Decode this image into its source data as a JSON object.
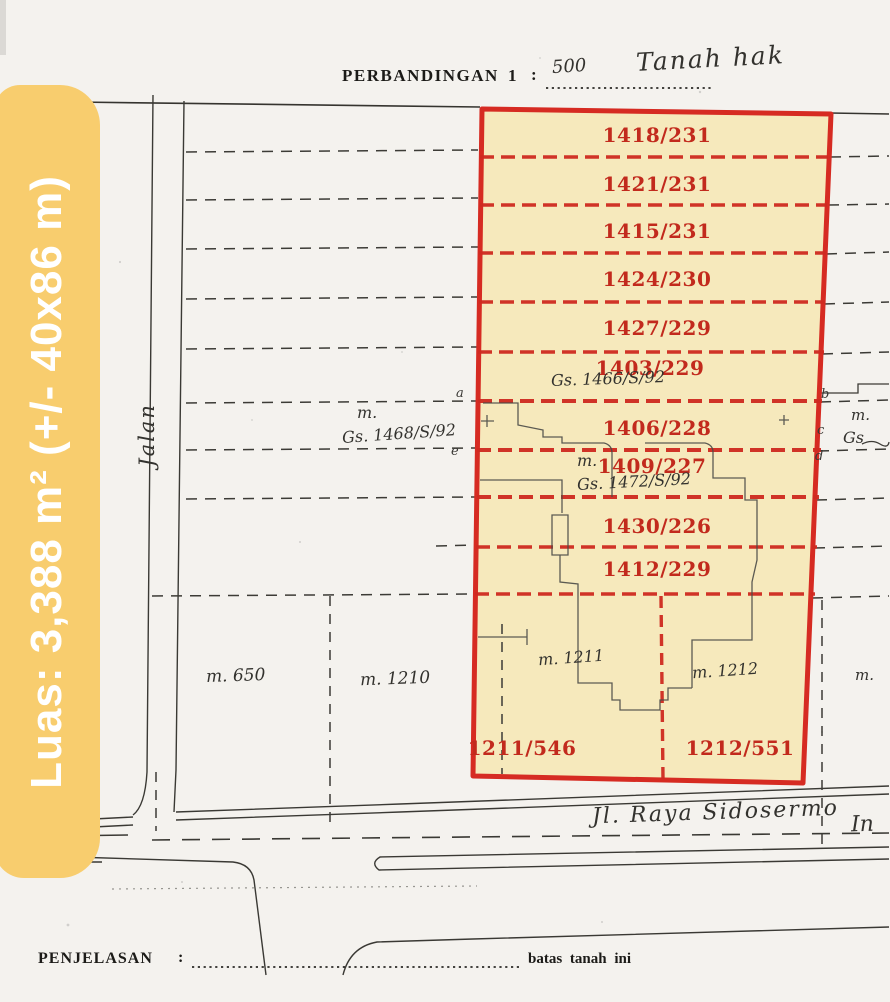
{
  "header": {
    "scale_label": "PERBANDINGAN",
    "scale_one": "1",
    "scale_colon": ":",
    "scale_value": "500",
    "handwritten_title": "Tanah hak"
  },
  "banner": {
    "text": "Luas: 3,388 m² (+/- 40x86 m)"
  },
  "map": {
    "parcels": [
      {
        "label": "1418/231"
      },
      {
        "label": "1421/231"
      },
      {
        "label": "1415/231"
      },
      {
        "label": "1424/230"
      },
      {
        "label": "1427/229"
      },
      {
        "label": "1403/229"
      },
      {
        "label": "1406/228"
      },
      {
        "label": "1409/227"
      },
      {
        "label": "1430/226"
      },
      {
        "label": "1412/229"
      },
      {
        "label": "1211/546"
      },
      {
        "label": "1212/551"
      }
    ],
    "survey_notes": {
      "gs_1466": "Gs. 1466/S/92",
      "m_left": "m.",
      "gs_1468": "Gs. 1468/S/92",
      "m_mid": "m.",
      "gs_1472": "Gs. 1472/S/92",
      "m_right": "m.",
      "gs_right": "Gs",
      "m_650": "m. 650",
      "m_1210": "m. 1210",
      "m_1211": "m. 1211",
      "m_1212": "m. 1212",
      "m_right_low": "m."
    },
    "edge_letters": {
      "a": "a",
      "b": "b",
      "c": "c",
      "d": "d",
      "e": "e"
    },
    "street_vertical": "Jalan",
    "street_bottom": "Jl. Raya Sidosermo",
    "street_bottom_cont": "In",
    "colors": {
      "highlight": "#f6e9bc",
      "outline": "#d62b22",
      "parcel_label": "#c22a1d",
      "banner": "#f8cd6e"
    }
  },
  "footer": {
    "label": "PENJELASAN",
    "colon": ":",
    "note": "batas tanah ini"
  }
}
